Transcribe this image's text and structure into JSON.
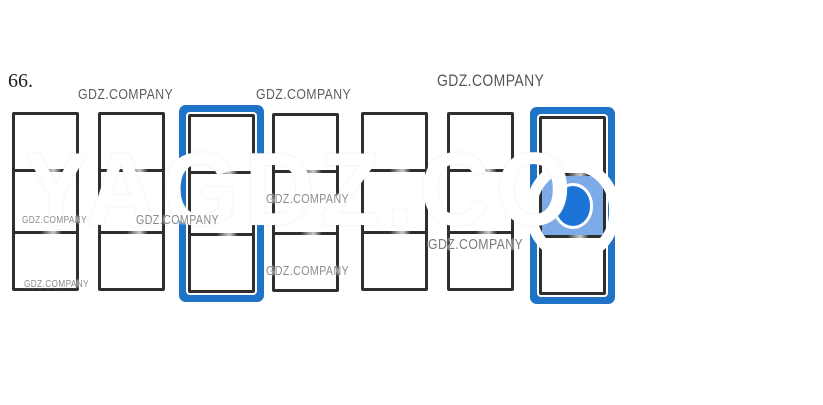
{
  "page": {
    "question_number": "66."
  },
  "watermark": {
    "text": "GDZ.COMPANY",
    "giant_text": "YAGDZ.CO",
    "color": "#6e6e6e"
  },
  "puzzle": {
    "description": "Seven tall three-cell frames; third and seventh are outlined in blue; seventh has its middle cell filled light blue with a dark blue dot.",
    "cards": [
      {
        "id": 1,
        "selected": false,
        "pip": false
      },
      {
        "id": 2,
        "selected": false,
        "pip": false
      },
      {
        "id": 3,
        "selected": true,
        "pip": false
      },
      {
        "id": 4,
        "selected": false,
        "pip": false
      },
      {
        "id": 5,
        "selected": false,
        "pip": false
      },
      {
        "id": 6,
        "selected": false,
        "pip": false
      },
      {
        "id": 7,
        "selected": true,
        "pip": true
      }
    ],
    "colors": {
      "frame": "#2e2e2e",
      "highlight_border": "#1e73c6",
      "pip_cell_fill": "#7cabe8",
      "pip_fill": "#1c74d6"
    }
  }
}
